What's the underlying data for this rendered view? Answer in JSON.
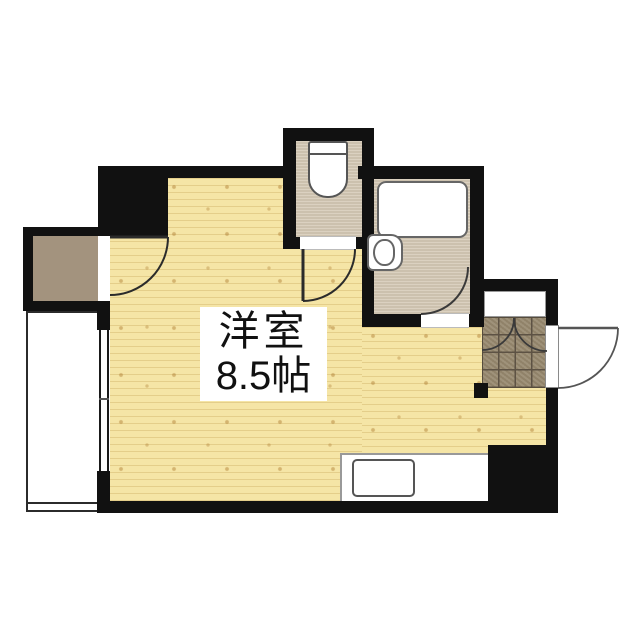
{
  "floorplan": {
    "room_label_line1": "洋室",
    "room_label_line2": "8.5帖"
  },
  "fixtures": [
    "closet",
    "closet-door-swing",
    "toilet",
    "toilet-door-swing",
    "bathtub",
    "washbasin",
    "bathroom-door-swing",
    "shoe-cabinet",
    "entrance-tile",
    "entry-door-swing",
    "kitchen-counter",
    "kitchen-sink",
    "window",
    "balcony"
  ],
  "colors": {
    "wall": "#111111",
    "wood_floor": "#f5e5a6",
    "wood_grain": "#c9a85c",
    "service_floor": "#d6cbb8",
    "closet_floor": "#a3937e",
    "entrance_tile": "#97896f",
    "tile_grout": "#564c3c",
    "fixture_outline": "#5a5a5a",
    "background": "#ffffff"
  }
}
